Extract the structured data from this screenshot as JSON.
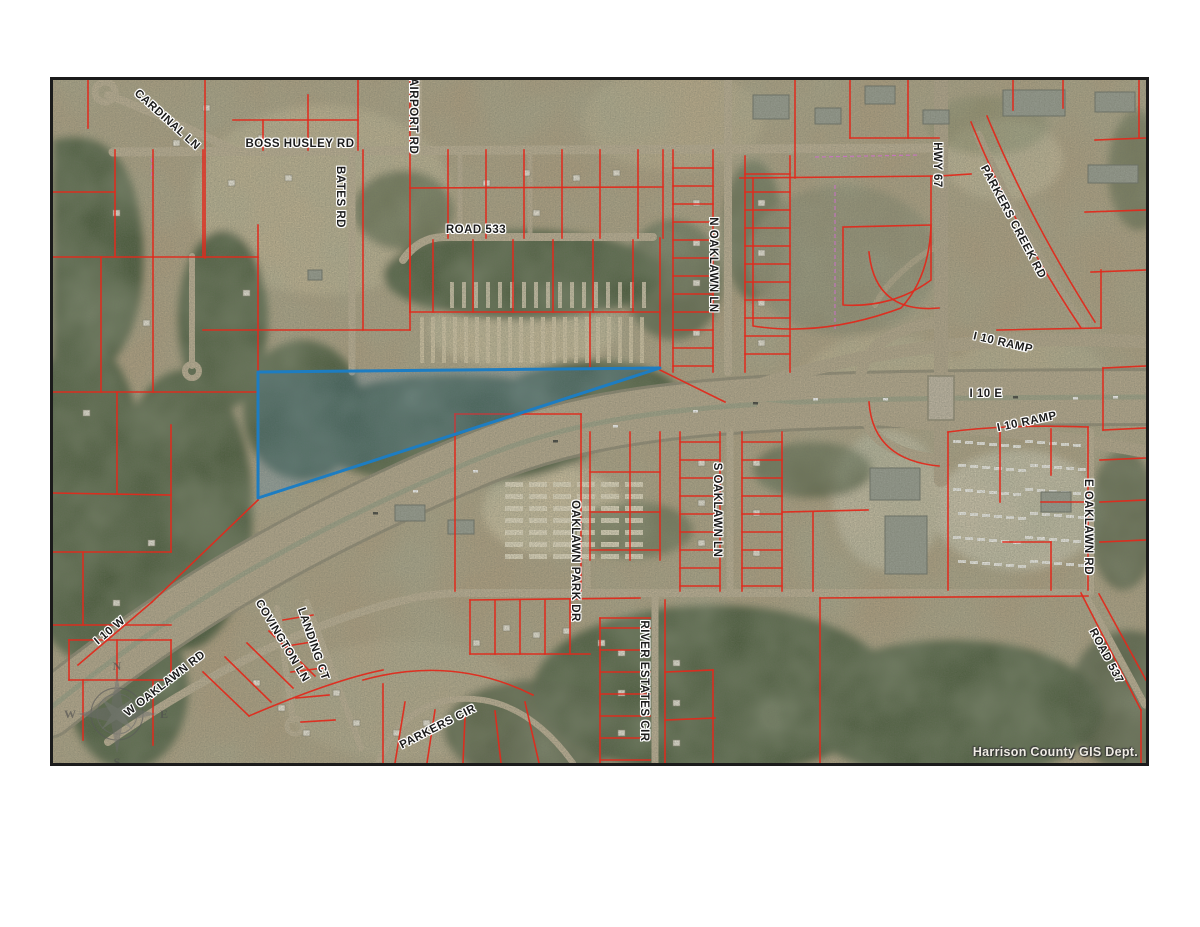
{
  "map": {
    "credit": "Harrison County GIS Dept.",
    "compass": {
      "north": "N",
      "east": "E",
      "south": "S",
      "west": "W"
    },
    "colors": {
      "parcel_line": "#e02a1c",
      "highlight_outline": "#1d7dc2",
      "highlight_fill": "rgba(61,130,195,0.20)",
      "survey_line": "#d36cd3",
      "label_color": "#1b1b1b",
      "credit_color": "#efece4"
    },
    "road_labels": [
      {
        "text": "CARDINAL LN",
        "x": 114,
        "y": 40,
        "rot": 42
      },
      {
        "text": "BOSS HUSLEY RD",
        "x": 247,
        "y": 64,
        "rot": 0
      },
      {
        "text": "AIRPORT RD",
        "x": 360,
        "y": 36,
        "rot": 90
      },
      {
        "text": "BATES RD",
        "x": 287,
        "y": 117,
        "rot": 90
      },
      {
        "text": "ROAD 533",
        "x": 423,
        "y": 150,
        "rot": 0
      },
      {
        "text": "N OAKLAWN LN",
        "x": 660,
        "y": 185,
        "rot": 90
      },
      {
        "text": "HWY 67",
        "x": 884,
        "y": 85,
        "rot": 90
      },
      {
        "text": "PARKERS CREEK RD",
        "x": 960,
        "y": 142,
        "rot": 62
      },
      {
        "text": "I 10 RAMP",
        "x": 950,
        "y": 263,
        "rot": 13
      },
      {
        "text": "I 10 E",
        "x": 933,
        "y": 314,
        "rot": 0
      },
      {
        "text": "I 10 RAMP",
        "x": 974,
        "y": 342,
        "rot": -12
      },
      {
        "text": "S OAKLAWN LN",
        "x": 664,
        "y": 430,
        "rot": 90
      },
      {
        "text": "OAKLAWN PARK DR",
        "x": 522,
        "y": 481,
        "rot": 90
      },
      {
        "text": "E OAKLAWN RD",
        "x": 1035,
        "y": 447,
        "rot": 90
      },
      {
        "text": "ROAD 537",
        "x": 1053,
        "y": 576,
        "rot": 62
      },
      {
        "text": "I 10 W",
        "x": 57,
        "y": 551,
        "rot": -40
      },
      {
        "text": "W OAKLAWN RD",
        "x": 112,
        "y": 604,
        "rot": -38
      },
      {
        "text": "COVINGTON LN",
        "x": 229,
        "y": 561,
        "rot": 59
      },
      {
        "text": "LANDING CT",
        "x": 260,
        "y": 564,
        "rot": 71
      },
      {
        "text": "PARKERS CIR",
        "x": 385,
        "y": 647,
        "rot": -27
      },
      {
        "text": "RIVER ESTATES CIR",
        "x": 591,
        "y": 601,
        "rot": 90
      }
    ]
  }
}
